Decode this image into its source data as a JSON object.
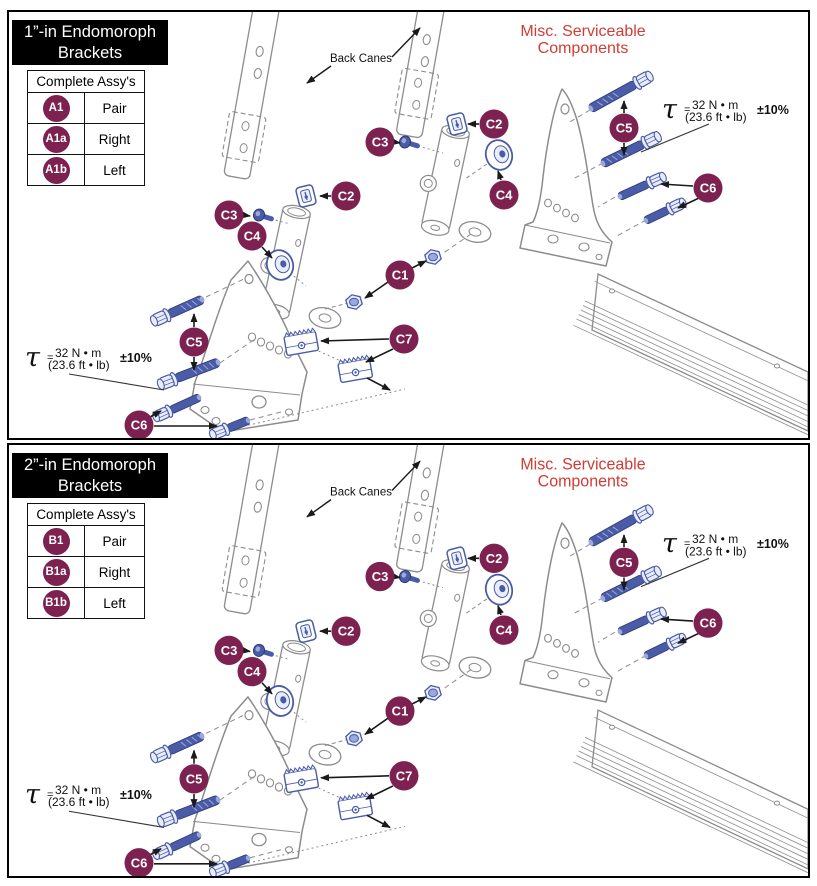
{
  "canvas": {
    "width": 817,
    "height": 886
  },
  "colors": {
    "background": "#ffffff",
    "panel_border": "#000000",
    "header_bg": "#000000",
    "header_text": "#ffffff",
    "badge_fill": "#7c2150",
    "badge_text": "#ffffff",
    "red_label": "#d13c35",
    "hardware_blue": "#4a5ca8",
    "hardware_light": "#9aa9dc",
    "hardware_fill": "#e9edf9",
    "line_art": "#8c8c8c",
    "arrow": "#1a1a1a"
  },
  "panels": [
    {
      "title_line1": "1”-in Endomoroph",
      "title_line2": "Brackets",
      "table": {
        "header": "Complete Assy's",
        "rows": [
          {
            "badge": "A1",
            "label": "Pair"
          },
          {
            "badge": "A1a",
            "label": "Right"
          },
          {
            "badge": "A1b",
            "label": "Left"
          }
        ]
      }
    },
    {
      "title_line1": "2”-in Endomoroph",
      "title_line2": "Brackets",
      "table": {
        "header": "Complete Assy's",
        "rows": [
          {
            "badge": "B1",
            "label": "Pair"
          },
          {
            "badge": "B1a",
            "label": "Right"
          },
          {
            "badge": "B1b",
            "label": "Left"
          }
        ]
      }
    }
  ],
  "diagram": {
    "misc_label_line1": "Misc. Serviceable",
    "misc_label_line2": "Components",
    "back_canes_label": "Back Canes",
    "torque": {
      "symbol": "τ",
      "equals": "=",
      "metric": "32 N • m",
      "imperial": "(23.6 ft • lb)",
      "tolerance": "±10%"
    },
    "callouts": [
      {
        "label": "C1",
        "x": 391,
        "y": 263,
        "arrows": [
          [
            403,
            256,
            417,
            249
          ],
          [
            379,
            270,
            356,
            286
          ]
        ]
      },
      {
        "label": "C2",
        "x": 485,
        "y": 112,
        "arrows": [
          [
            470,
            112,
            459,
            112
          ]
        ]
      },
      {
        "label": "C2",
        "x": 337,
        "y": 184,
        "arrows": [
          [
            322,
            184,
            311,
            184
          ]
        ]
      },
      {
        "label": "C3",
        "x": 371,
        "y": 130,
        "arrows": [
          [
            385,
            130,
            391,
            131
          ]
        ]
      },
      {
        "label": "C3",
        "x": 220,
        "y": 203,
        "arrows": [
          [
            234,
            203,
            241,
            204
          ]
        ]
      },
      {
        "label": "C4",
        "x": 495,
        "y": 183,
        "arrows": [
          [
            492,
            168,
            489,
            159
          ]
        ]
      },
      {
        "label": "C4",
        "x": 243,
        "y": 224,
        "arrows": [
          [
            253,
            235,
            263,
            246
          ]
        ]
      },
      {
        "label": "C5",
        "x": 615,
        "y": 116,
        "arrows": [
          [
            615,
            101,
            615,
            89
          ],
          [
            615,
            131,
            615,
            143
          ]
        ]
      },
      {
        "label": "C5",
        "x": 185,
        "y": 330,
        "arrows": [
          [
            185,
            315,
            185,
            302
          ],
          [
            185,
            345,
            185,
            358
          ]
        ]
      },
      {
        "label": "C6",
        "x": 699,
        "y": 176,
        "arrows": [
          [
            684,
            174,
            652,
            172
          ],
          [
            690,
            186,
            669,
            196
          ]
        ]
      },
      {
        "label": "C6",
        "x": 130,
        "y": 413,
        "arrows": [
          [
            141,
            405,
            152,
            399
          ],
          [
            145,
            414,
            208,
            414
          ]
        ]
      },
      {
        "label": "C7",
        "x": 395,
        "y": 327,
        "arrows": [
          [
            380,
            327,
            312,
            329
          ],
          [
            384,
            337,
            357,
            350
          ],
          [
            358,
            366,
            381,
            378
          ]
        ]
      }
    ]
  }
}
